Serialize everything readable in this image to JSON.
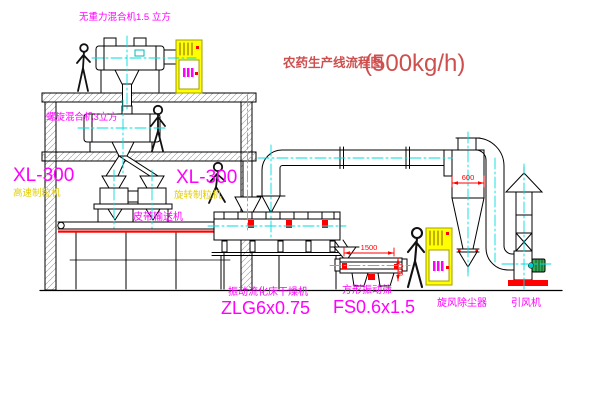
{
  "title": {
    "name": "农药生产线流程图",
    "capacity": "(500kg/h)"
  },
  "equipment_labels": {
    "gravityless_mixer": "无重力混合机1.5 立方",
    "screw_mixer": "螺旋混合机3立方",
    "granulator_left_model": "XL-300",
    "granulator_left_name": "高速制粒机",
    "granulator_right_model": "XL-300",
    "granulator_right_name": "旋转制粒机",
    "belt_conveyor": "皮带输送机",
    "fluid_bed_dryer_name": "振动流化床干燥机",
    "fluid_bed_dryer_model": "ZLG6x0.75",
    "vibrating_sieve_name": "方形振动筛",
    "vibrating_sieve_model": "FS0.6x1.5",
    "cyclone_collector": "旋风除尘器",
    "induced_draft_fan": "引风机"
  },
  "dimensions": {
    "cyclone_diameter": "600",
    "sieve_length": "1500",
    "sieve_height": "600"
  },
  "colors": {
    "label_magenta": "#ff00ff",
    "label_yellow": "#e3cf00",
    "dimension_red": "#ff0000",
    "title_red": "#cf4f4f",
    "centerline_cyan": "#00dede",
    "cabinet_yellow": "#ffff00",
    "motor_green": "#33aa55"
  }
}
